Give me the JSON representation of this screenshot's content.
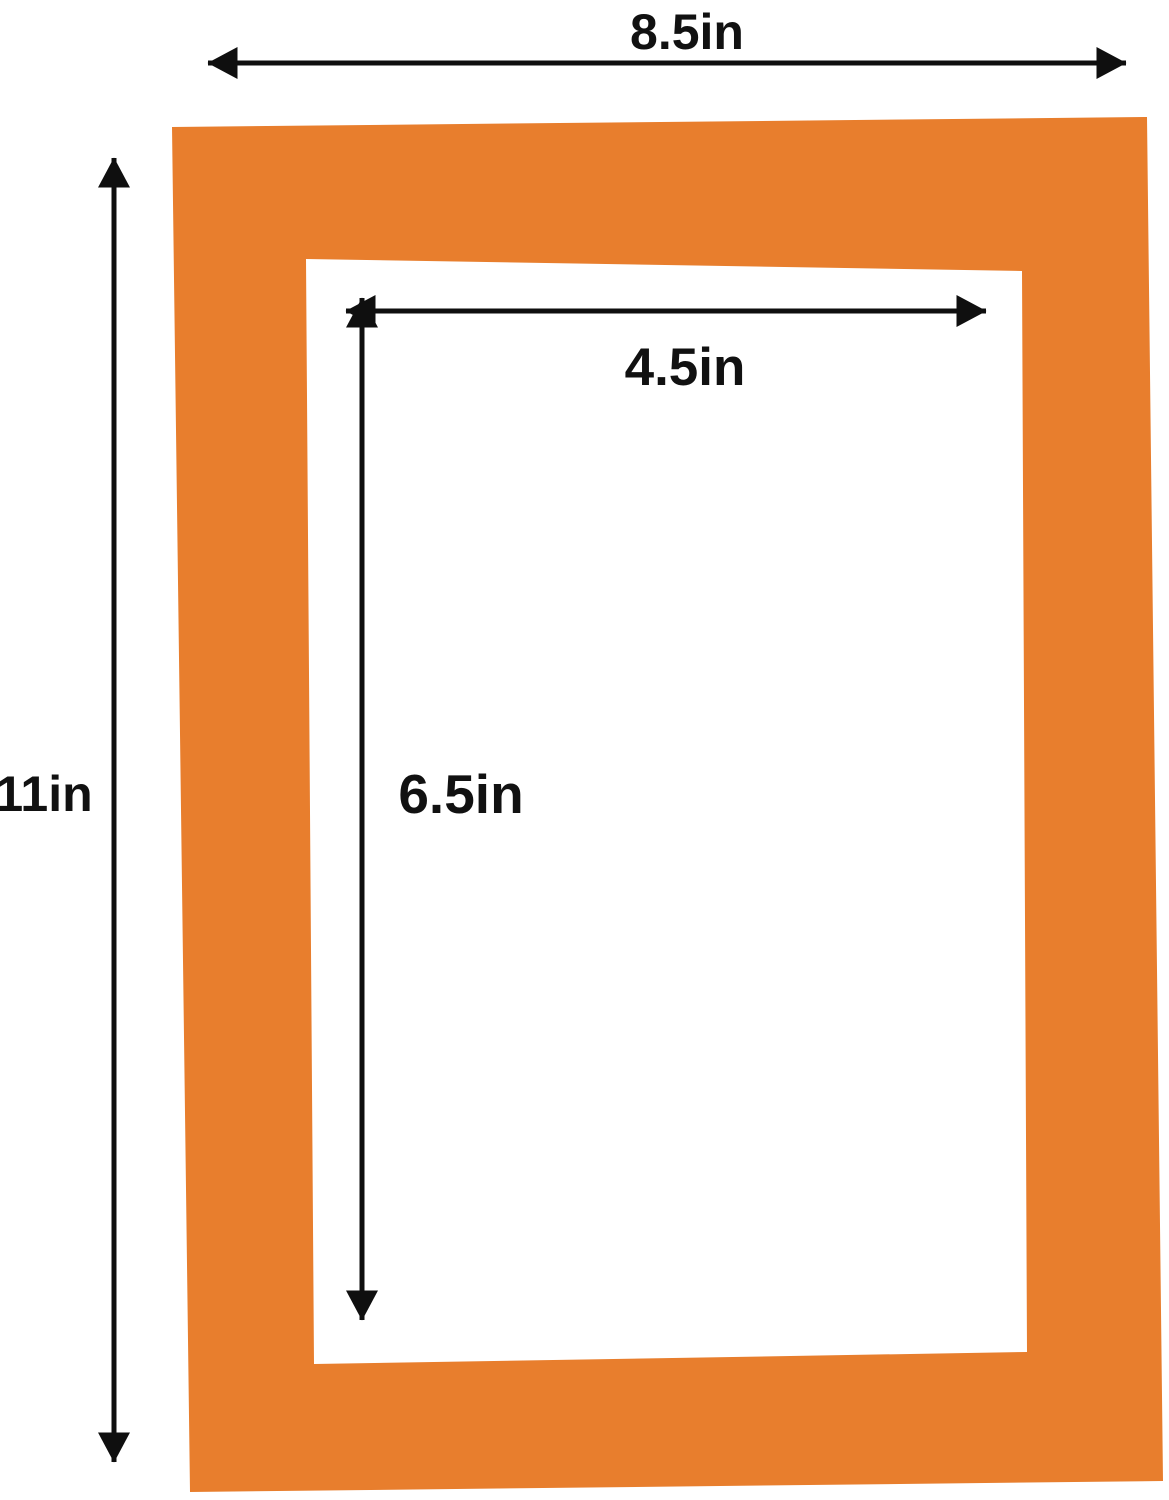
{
  "diagram": {
    "title": "Picture mat dimension diagram",
    "outer": {
      "width_label": "8.5in",
      "height_label": "11in"
    },
    "opening": {
      "width_label": "4.5in",
      "height_label": "6.5in"
    },
    "colors": {
      "mat_orange": "#E87E2D",
      "line_black": "#0f0f0f",
      "background": "#ffffff"
    }
  }
}
